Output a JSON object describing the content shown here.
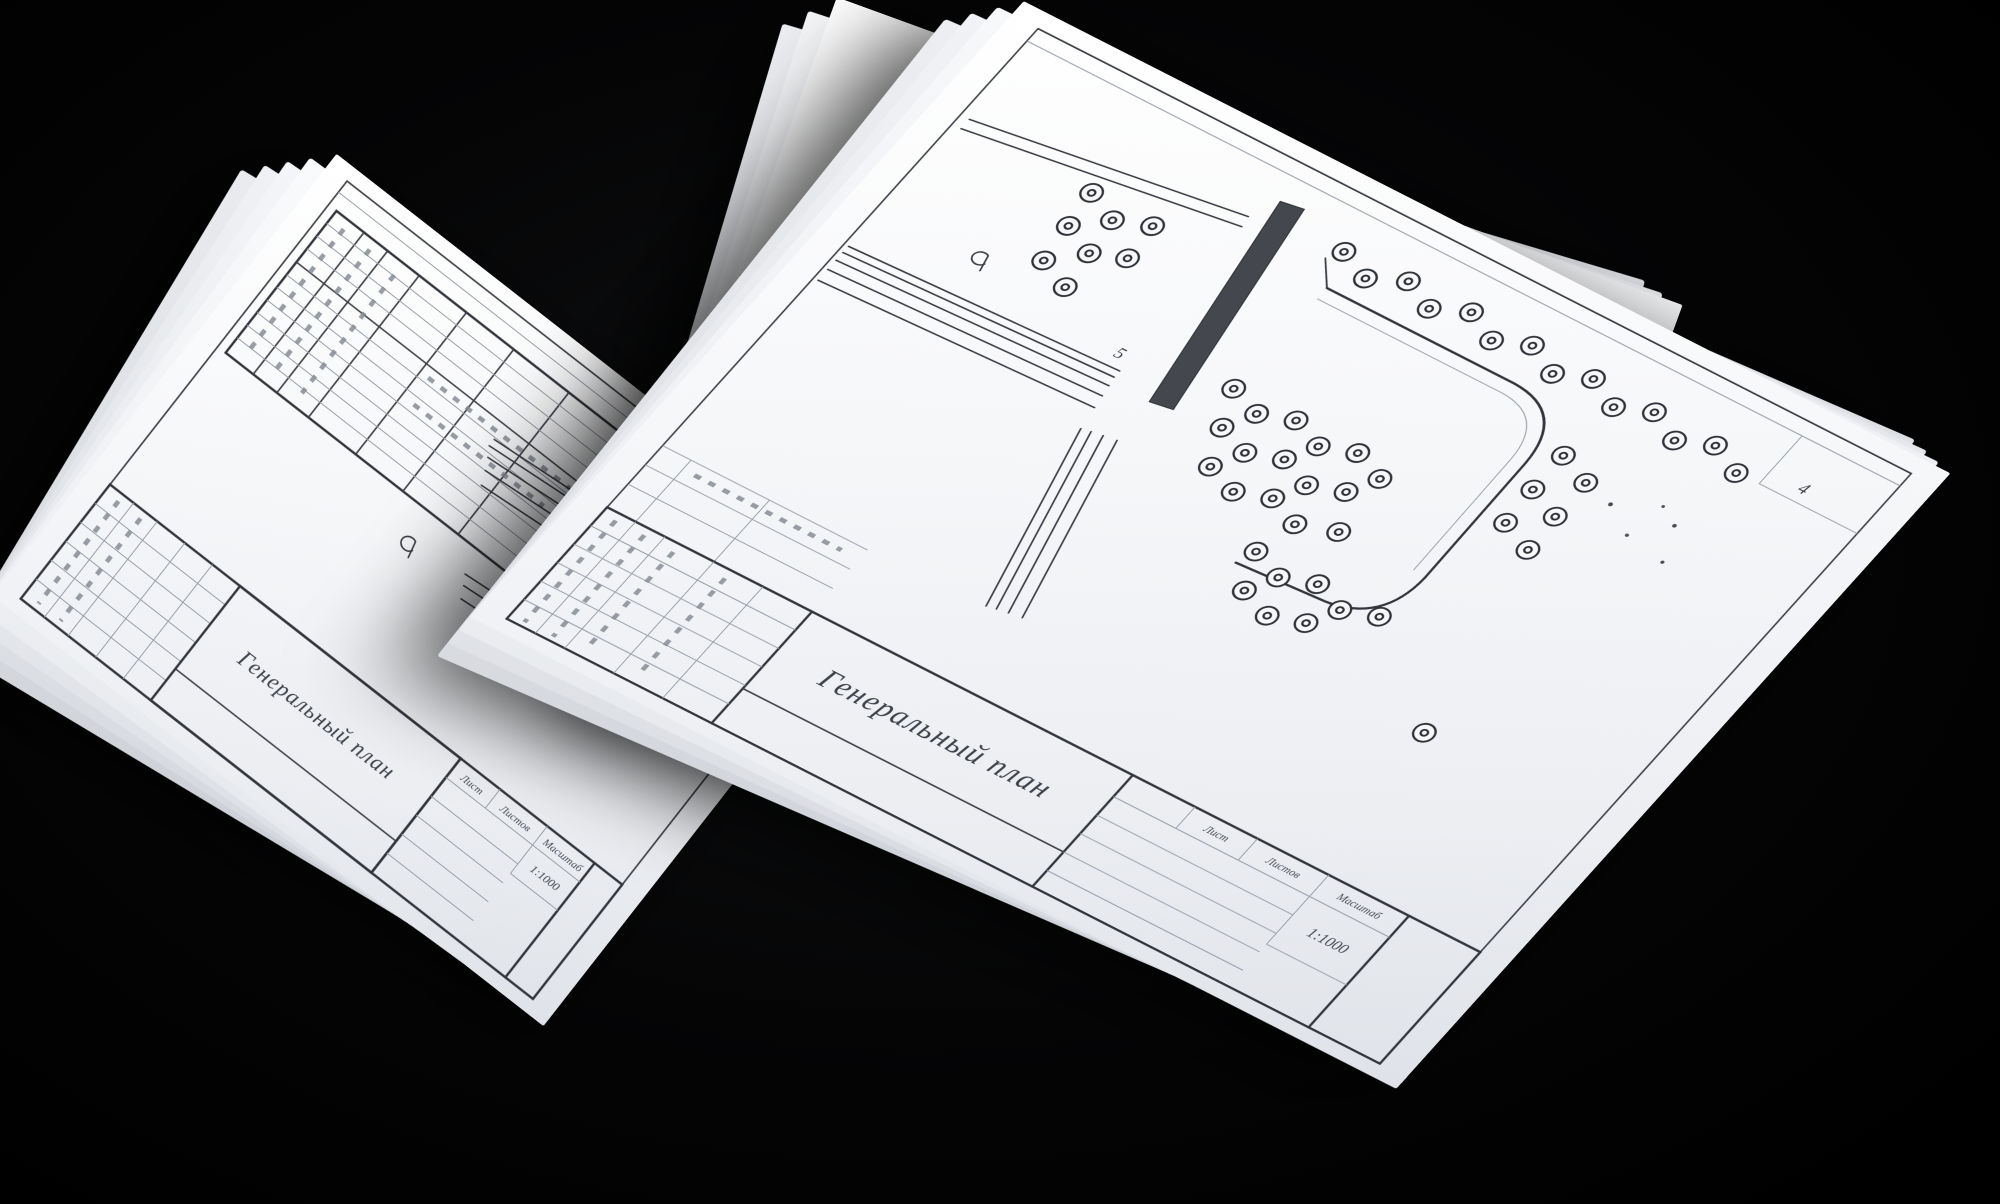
{
  "scene": {
    "background_color": "#000000",
    "paper_color": "#f4f5f7",
    "ink_color": "#3a3c43"
  },
  "icons": {
    "tree_symbol": "◎"
  },
  "sheets": {
    "front": {
      "title": "Генеральный план",
      "scale": "1:1000",
      "labels": {
        "sheet": "Лист",
        "sheets_total": "Листов",
        "scale_label": "Масштаб"
      },
      "annotations": {
        "building_number": "5",
        "area_number": "4"
      }
    },
    "back": {
      "title": "Генеральный план",
      "scale": "1:1000",
      "labels": {
        "sheet": "Лист",
        "sheets_total": "Листов",
        "scale_label": "Масштаб"
      }
    }
  }
}
